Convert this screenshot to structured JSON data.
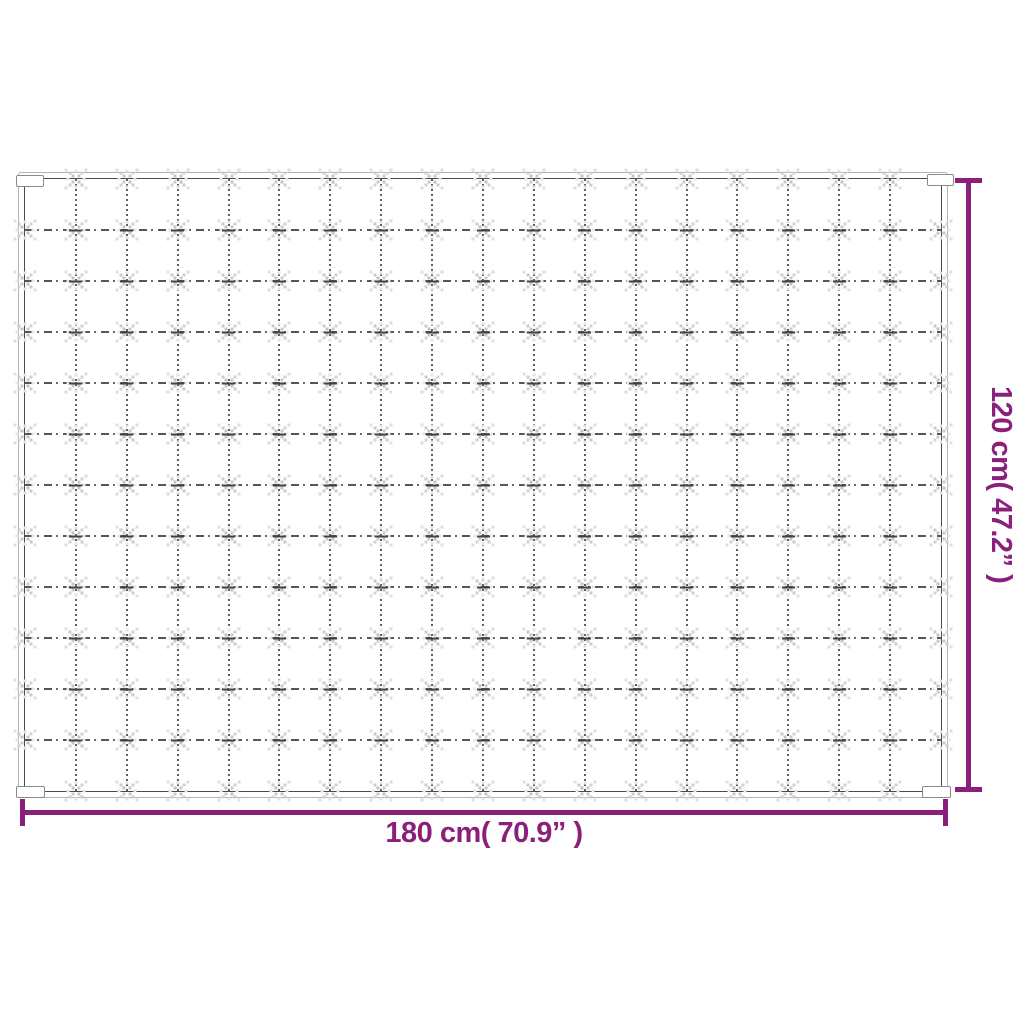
{
  "colors": {
    "accent": "#8a1f7c",
    "blanket_edge_dark": "#4a4a4a",
    "blanket_edge_light": "#b3b3b3",
    "quilt_line": "#5f5f5f",
    "tuft": "#cccccc"
  },
  "dimensions": {
    "width_label": "180 cm( 70.9” )",
    "height_label": "120 cm( 47.2” )"
  },
  "blanket": {
    "grid": {
      "columns": 18,
      "rows": 12
    }
  }
}
